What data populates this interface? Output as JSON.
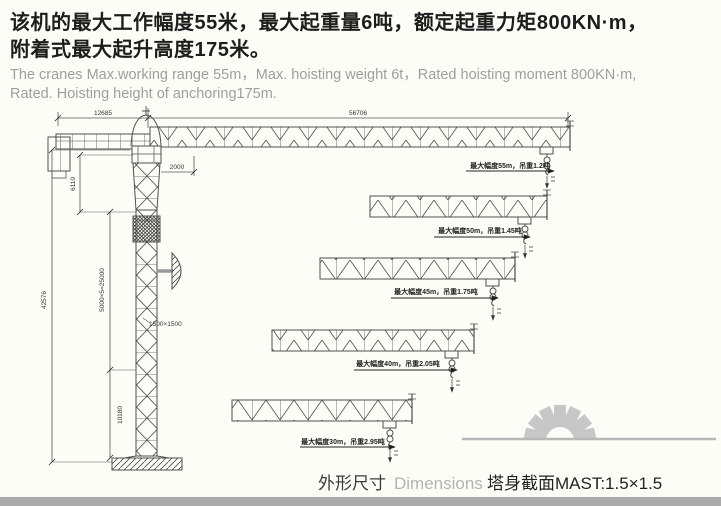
{
  "header": {
    "cn_line1": "该机的最大工作幅度55米，最大起重量6吨，额定起重力矩800KN·m，",
    "cn_line2": "附着式最大起升高度175米。",
    "en_line1": "The cranes Max.working range 55m，Max. hoisting weight 6t，Rated hoisting moment 800KN·m,",
    "en_line2": "Rated. Hoisting height of anchoring175m."
  },
  "drawing": {
    "dims": {
      "counter_jib_length": "12685",
      "main_jib_length": "56706",
      "jib_root_offset": "2000",
      "head_section_height": "6110",
      "total_height": "42576",
      "standard_sections": "5000×5=25000",
      "mast_cross_section": "1500×1500",
      "base_section_height": "10180"
    },
    "configs": [
      {
        "label": "最大幅度55m，吊重1.2吨"
      },
      {
        "label": "最大幅度50m，吊重1.45吨"
      },
      {
        "label": "最大幅度45m，吊重1.75吨"
      },
      {
        "label": "最大幅度40m，吊重2.05吨"
      },
      {
        "label": "最大幅度30m，吊重2.95吨"
      }
    ]
  },
  "footer": {
    "caption_cn": "外形尺寸",
    "caption_en": "Dimensions",
    "mast_caption": "塔身截面MAST:1.5×1.5"
  },
  "colors": {
    "ink": "#1d1d1d",
    "muted_text": "#9e9e9e",
    "drawing_line": "#4f4f4f",
    "logo_gray": "#c7c7c7",
    "bottom_bar": "#ababab"
  }
}
